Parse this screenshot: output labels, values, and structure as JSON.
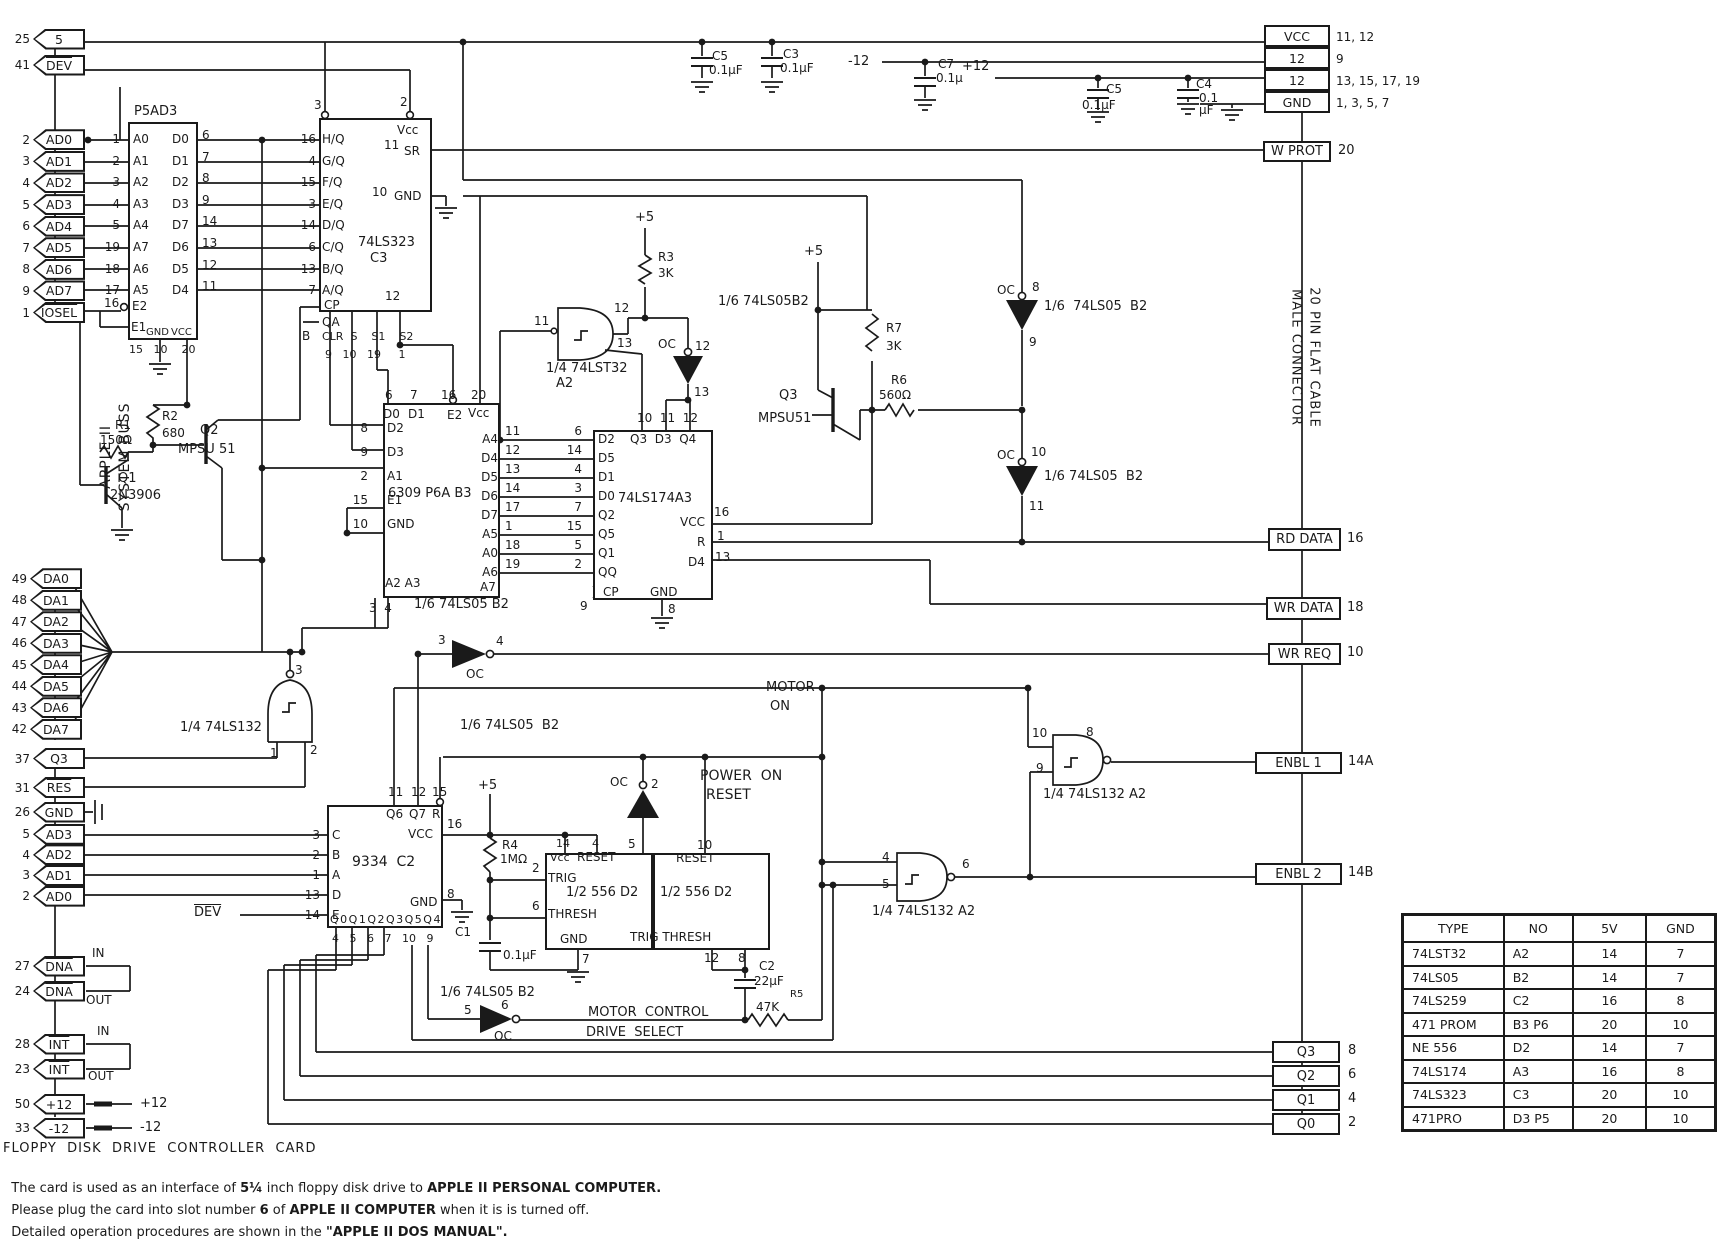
{
  "bus": {
    "vlabel1": "APPLE II",
    "vlabel2": "SYSTEM BUSS",
    "top_tags": [
      {
        "pin": "25",
        "label": "5",
        "bar": false
      },
      {
        "pin": "41",
        "label": "DEV",
        "bar": true
      }
    ],
    "addr_tags": [
      {
        "pin": "2",
        "label": "AD0"
      },
      {
        "pin": "3",
        "label": "AD1"
      },
      {
        "pin": "4",
        "label": "AD2"
      },
      {
        "pin": "5",
        "label": "AD3"
      },
      {
        "pin": "6",
        "label": "AD4"
      },
      {
        "pin": "7",
        "label": "AD5"
      },
      {
        "pin": "8",
        "label": "AD6"
      },
      {
        "pin": "9",
        "label": "AD7"
      },
      {
        "pin": "1",
        "label": "IOSEL",
        "bar": true
      }
    ],
    "data_tags": [
      {
        "pin": "49",
        "label": "DA0"
      },
      {
        "pin": "48",
        "label": "DA1"
      },
      {
        "pin": "47",
        "label": "DA2"
      },
      {
        "pin": "46",
        "label": "DA3"
      },
      {
        "pin": "45",
        "label": "DA4"
      },
      {
        "pin": "44",
        "label": "DA5"
      },
      {
        "pin": "43",
        "label": "DA6"
      },
      {
        "pin": "42",
        "label": "DA7"
      }
    ],
    "ctrl_tags": [
      {
        "pin": "37",
        "label": "Q3"
      },
      {
        "pin": "31",
        "label": "RES",
        "bar": true
      }
    ],
    "gnd_tag": {
      "pin": "26",
      "label": "GND"
    },
    "addr2_tags": [
      {
        "pin": "5",
        "label": "AD3"
      },
      {
        "pin": "4",
        "label": "AD2"
      },
      {
        "pin": "3",
        "label": "AD1"
      },
      {
        "pin": "2",
        "label": "AD0"
      }
    ],
    "io_tags": [
      {
        "pin": "27",
        "label": "DNA",
        "note": "IN"
      },
      {
        "pin": "24",
        "label": "DNA",
        "note": "OUT"
      },
      {
        "pin": "28",
        "label": "INT",
        "note": "IN"
      },
      {
        "pin": "23",
        "label": "INT",
        "note": "OUT"
      },
      {
        "pin": "50",
        "label": "+12",
        "note": "+12"
      },
      {
        "pin": "33",
        "label": "-12",
        "note": "-12"
      }
    ]
  },
  "ics": {
    "prom": {
      "title": "P5AD3",
      "rows": [
        {
          "lp": "1",
          "ll": "A0",
          "rl": "D0",
          "rp": "6"
        },
        {
          "lp": "2",
          "ll": "A1",
          "rl": "D1",
          "rp": "7"
        },
        {
          "lp": "3",
          "ll": "A2",
          "rl": "D2",
          "rp": "8"
        },
        {
          "lp": "4",
          "ll": "A3",
          "rl": "D3",
          "rp": "9"
        },
        {
          "lp": "5",
          "ll": "A4",
          "rl": "D7",
          "rp": "14"
        },
        {
          "lp": "19",
          "ll": "A7",
          "rl": "D6",
          "rp": "13"
        },
        {
          "lp": "18",
          "ll": "A6",
          "rl": "D5",
          "rp": "12"
        },
        {
          "lp": "17",
          "ll": "A5",
          "rl": "D4",
          "rp": "11"
        }
      ],
      "e2_pin": "16",
      "e2": "E2",
      "e1": "E1",
      "gnd": "GND",
      "vcc": "VCC",
      "bottom_pins": "15   10    20"
    },
    "ls323": {
      "title": "74LS323",
      "no": "C3",
      "vcc": "Vcc",
      "g2_pin": "3",
      "g1_pin": "2",
      "sr": "SR",
      "sr_pin": "11",
      "gnd": "GND",
      "gnd_pin": "10",
      "rows": [
        {
          "p": "16",
          "l": "H/Q"
        },
        {
          "p": "4",
          "l": "G/Q"
        },
        {
          "p": "15",
          "l": "F/Q"
        },
        {
          "p": "3",
          "l": "E/Q"
        },
        {
          "p": "14",
          "l": "D/Q"
        },
        {
          "p": "6",
          "l": "C/Q"
        },
        {
          "p": "13",
          "l": "B/Q"
        },
        {
          "p": "7",
          "l": "A/Q"
        }
      ],
      "cp": "CP",
      "cp_pin": "12",
      "qa": "QA",
      "b": "B",
      "bottom_labels": "CLR  S    S1    S2",
      "bottom_pins": "9   10   19     1"
    },
    "rom6309": {
      "title": "6309 P6A B3",
      "top_pins": [
        "6",
        "7",
        "16",
        "20"
      ],
      "top_labels": [
        "D0",
        "D1",
        "E2",
        "Vcc"
      ],
      "left": [
        {
          "p": "8",
          "l": "D2"
        },
        {
          "p": "9",
          "l": "D3"
        },
        {
          "p": "2",
          "l": "A1"
        },
        {
          "p": "15",
          "l": "E1"
        },
        {
          "p": "10",
          "l": "GND"
        }
      ],
      "a7": "A7",
      "bottom": "A2 A3",
      "bottom_pins": "3  4",
      "rows": [
        {
          "ll": "A4",
          "lp": "11",
          "rp": "6",
          "rl": "D2"
        },
        {
          "ll": "D4",
          "lp": "12",
          "rp": "14",
          "rl": "D5"
        },
        {
          "ll": "D5",
          "lp": "13",
          "rp": "4",
          "rl": "D1"
        },
        {
          "ll": "D6",
          "lp": "14",
          "rp": "3",
          "rl": "D0"
        },
        {
          "ll": "D7",
          "lp": "17",
          "rp": "7",
          "rl": "Q2"
        },
        {
          "ll": "A5",
          "lp": "1",
          "rp": "15",
          "rl": "Q5"
        },
        {
          "ll": "A0",
          "lp": "18",
          "rp": "5",
          "rl": "Q1"
        },
        {
          "ll": "A6",
          "lp": "19",
          "rp": "2",
          "rl": "QQ"
        }
      ]
    },
    "ls174": {
      "title": "74LS174A3",
      "top_pins": "10  11  12",
      "top_labels": "Q3  D3  Q4",
      "vcc": "VCC",
      "vcc_pin": "16",
      "r": "R",
      "r_pin": "1",
      "d4": "D4",
      "d4_pin": "13",
      "gnd": "GND",
      "gnd_pin": "8",
      "cp": "CP",
      "cp_pin": "9"
    },
    "latch9334": {
      "title": "9334  C2",
      "left": [
        {
          "p": "3",
          "l": "C"
        },
        {
          "p": "2",
          "l": "B"
        },
        {
          "p": "1",
          "l": "A"
        },
        {
          "p": "13",
          "l": "D"
        },
        {
          "p": "14",
          "l": "E"
        }
      ],
      "top_labels": [
        "Q6",
        "Q7",
        "R"
      ],
      "top_pins": [
        "11",
        "12",
        "15"
      ],
      "vcc": "VCC",
      "vcc_pin": "16",
      "gnd": "GND",
      "gnd_pin": "8",
      "bottom_labels": "Q0Q1Q2Q3Q5Q4",
      "bottom_pins": "4   5   6   7   10   9"
    },
    "timer1": {
      "title": "1/2 556 D2",
      "vcc": "Vcc",
      "vcc_pin": "14",
      "reset": "RESET",
      "reset_pin": "4",
      "trig": "TRIG",
      "trig_pin": "2",
      "thresh": "THRESH",
      "thresh_pin": "6",
      "gnd": "GND",
      "gnd_pin": "7",
      "out_pin": "5"
    },
    "timer2": {
      "title": "1/2 556 D2",
      "reset": "RESET",
      "reset_pin": "10",
      "bottom": "TRIG THRESH",
      "pin12": "12",
      "pin8": "8"
    }
  },
  "gates": {
    "t32": {
      "label": "1/4 74LST32",
      "no": "A2",
      "in": "11",
      "out": "12",
      "aux": "13"
    },
    "ls132a": {
      "label": "1/4 74LS132",
      "in1": "1",
      "in2": "2",
      "out": "3"
    },
    "enbl1_gate": {
      "label": "1/4 74LS132 A2",
      "in1": "10",
      "in2": "9",
      "out": "8"
    },
    "enbl2_gate": {
      "label": "1/4 74LS132 A2",
      "in1": "4",
      "in2": "5",
      "out": "6"
    },
    "inv_top": {
      "label": "1/6 74LS05B2",
      "oc": "OC",
      "in": "12",
      "out": "13"
    },
    "inv_oc8": {
      "label": "1/6  74LS05  B2",
      "oc": "OC",
      "pt": "8",
      "pb": "9"
    },
    "inv_oc10": {
      "label": "1/6 74LS05  B2",
      "oc": "OC",
      "pt": "10",
      "pb": "11"
    },
    "inv_wrreq": {
      "label": "1/6 74LS05 B2",
      "oc": "OC",
      "in": "3",
      "out": "4"
    },
    "inv_por": {
      "label": "1/6 74LS05  B2",
      "oc": "OC",
      "out": "2",
      "in": "5"
    },
    "inv_motor": {
      "label": "1/6 74LS05 B2",
      "oc": "OC",
      "in": "5",
      "out": "6"
    }
  },
  "parts": {
    "r1": {
      "ref": "R1",
      "val": "150Ω"
    },
    "r2": {
      "ref": "R2",
      "val": "680"
    },
    "r3": {
      "ref": "R3",
      "val": "3K"
    },
    "r4": {
      "ref": "R4",
      "val": "1MΩ"
    },
    "r5": {
      "ref": "R5",
      "val": "47K"
    },
    "r6": {
      "ref": "R6",
      "val": "560Ω"
    },
    "r7": {
      "ref": "R7",
      "val": "3K"
    },
    "c1": {
      "ref": "C1",
      "val": "0.1μF"
    },
    "c2": {
      "ref": "C2",
      "val": "22μF"
    },
    "c3": {
      "ref": "C3",
      "val": "0.1μF"
    },
    "c4": {
      "ref": "C4",
      "val1": "0.1",
      "val2": "μF"
    },
    "c5a": {
      "ref": "C5",
      "val": "0.1μF"
    },
    "c5b": {
      "ref": "C5",
      "val": "0.1μF"
    },
    "c7": {
      "ref": "C7",
      "val": "0.1μ"
    },
    "q1": {
      "ref": "Q1",
      "val": "2N3906"
    },
    "q2": {
      "ref": "Q2",
      "val": "MPSU 51"
    },
    "q3": {
      "ref": "Q3",
      "val": "MPSU51"
    }
  },
  "signals": {
    "plus5": "+5",
    "plus12": "+12",
    "minus12": "-12",
    "por1": "POWER  ON",
    "por2": "RESET",
    "motor1": "MOTOR",
    "motor2": "ON",
    "motor_control": "MOTOR  CONTROL",
    "drive_select": "DRIVE  SELECT",
    "dev": "DEV"
  },
  "connector": {
    "vlabel1": "20 PIN FLAT CABLE",
    "vlabel2": "MALE CONNECTOR",
    "power_rows": [
      {
        "label": "VCC",
        "pins": "11, 12"
      },
      {
        "label": "12",
        "pins": "9"
      },
      {
        "label": "12",
        "pins": "13, 15, 17, 19"
      },
      {
        "label": "GND",
        "pins": "1, 3, 5, 7"
      }
    ],
    "signals": [
      {
        "label": "W PROT",
        "pin": "20"
      },
      {
        "label": "RD DATA",
        "pin": "16"
      },
      {
        "label": "WR DATA",
        "pin": "18"
      },
      {
        "label": "WR REQ",
        "pin": "10"
      },
      {
        "label": "ENBL 1",
        "pin": "14A"
      },
      {
        "label": "ENBL 2",
        "pin": "14B"
      },
      {
        "label": "Q3",
        "pin": "8"
      },
      {
        "label": "Q2",
        "pin": "6"
      },
      {
        "label": "Q1",
        "pin": "4"
      },
      {
        "label": "Q0",
        "pin": "2"
      }
    ]
  },
  "table": {
    "headers": [
      "TYPE",
      "NO",
      "5V",
      "GND"
    ],
    "rows": [
      [
        "74LST32",
        "A2",
        "14",
        "7"
      ],
      [
        "74LS05",
        "B2",
        "14",
        "7"
      ],
      [
        "74LS259",
        "C2",
        "16",
        "8"
      ],
      [
        "471 PROM",
        "B3  P6",
        "20",
        "10"
      ],
      [
        "NE 556",
        "D2",
        "14",
        "7"
      ],
      [
        "74LS174",
        "A3",
        "16",
        "8"
      ],
      [
        "74LS323",
        "C3",
        "20",
        "10"
      ],
      [
        "471PRO",
        "D3  P5",
        "20",
        "10"
      ]
    ]
  },
  "notes": {
    "title": "FLOPPY  DISK  DRIVE  CONTROLLER  CARD",
    "l2": [
      "The card is used as an interface of ",
      "5¼",
      " inch floppy disk drive to ",
      "APPLE II PERSONAL COMPUTER."
    ],
    "l3": [
      "Please plug the card into slot number ",
      "6",
      " of ",
      "APPLE II COMPUTER",
      " when it is is turned off."
    ],
    "l4": [
      "Detailed operation procedures are shown in the ",
      "\"APPLE II DOS MANUAL\"."
    ]
  }
}
